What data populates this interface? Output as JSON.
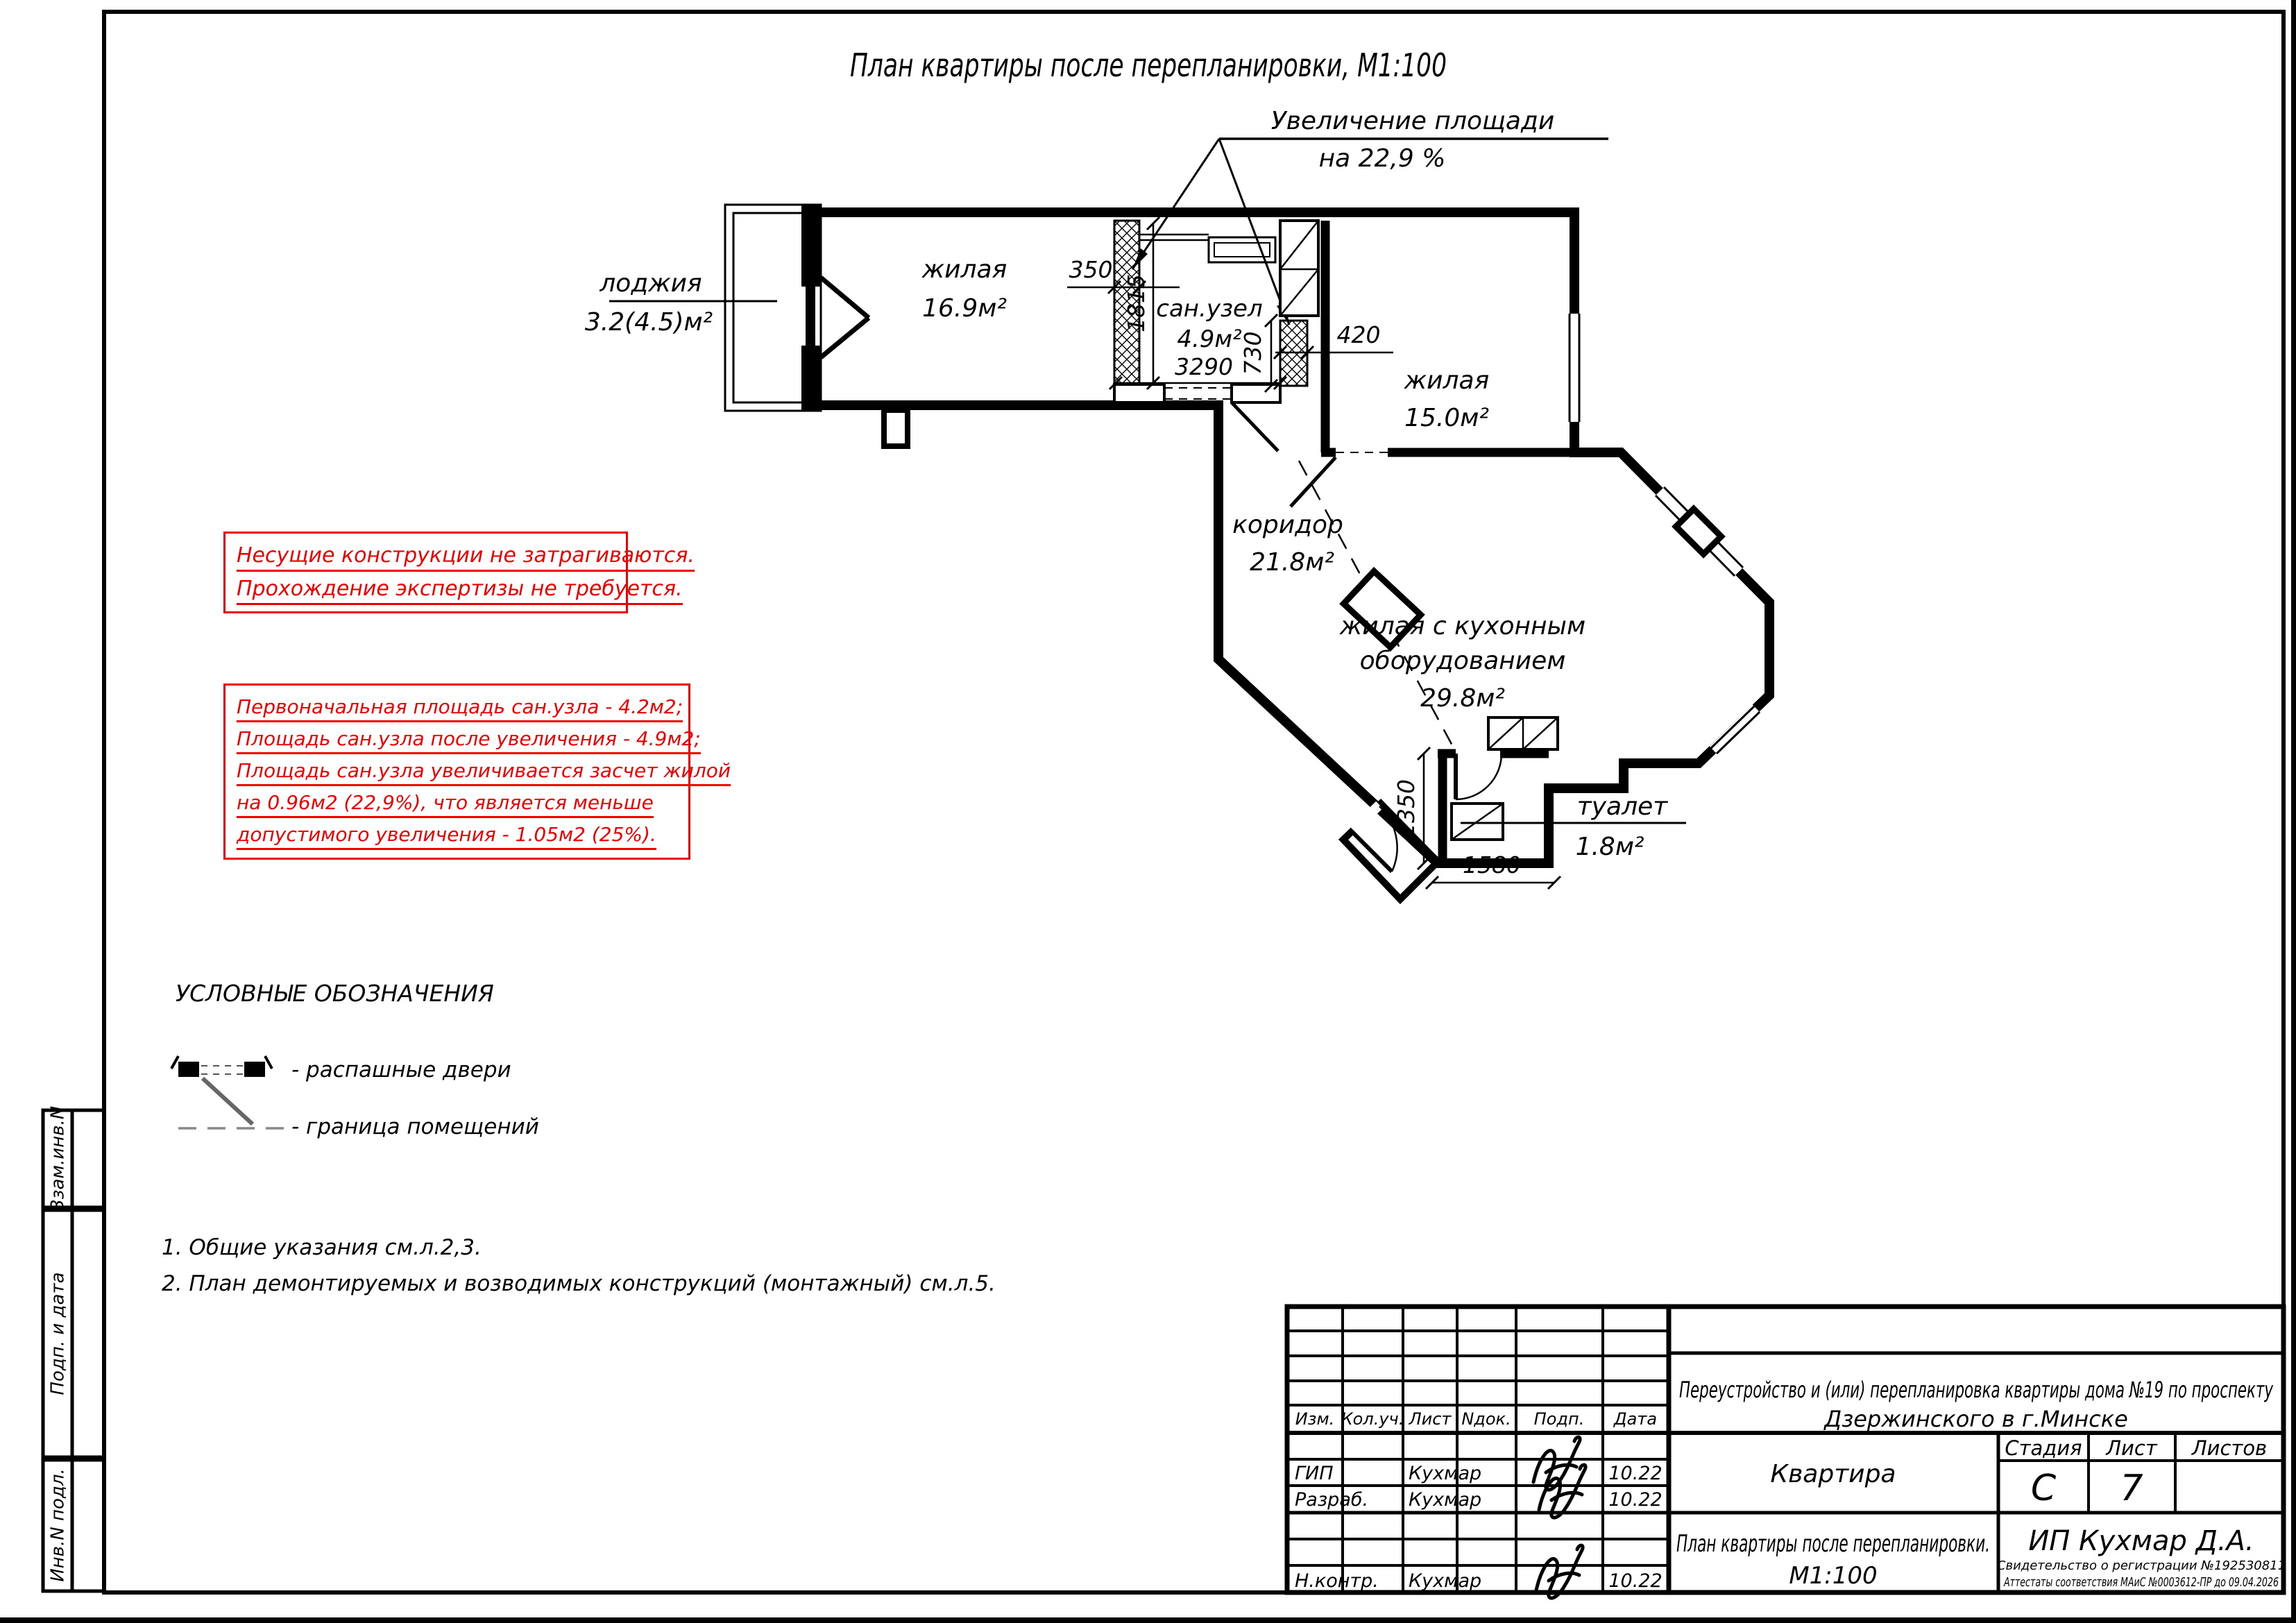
{
  "title": "План квартиры после перепланировки, М1:100",
  "callout": {
    "line1": "Увеличение площади",
    "line2": "на 22,9 %"
  },
  "rooms": {
    "loggia": {
      "name": "лоджия",
      "area": "3.2(4.5)м²"
    },
    "living1": {
      "name": "жилая",
      "area": "16.9м²"
    },
    "san": {
      "name": "сан.узел",
      "area": "4.9м²"
    },
    "living2": {
      "name": "жилая",
      "area": "15.0м²"
    },
    "corridor": {
      "name": "коридор",
      "area": "21.8м²"
    },
    "kitchen": {
      "line1": "жилая с кухонным",
      "line2": "оборудованием",
      "area": "29.8м²"
    },
    "toilet": {
      "name": "туалет",
      "area": "1.8м²"
    }
  },
  "dims": {
    "d350": "350",
    "d1815": "1815",
    "d3290": "3290",
    "d730": "730",
    "d420": "420",
    "d1350": "1350",
    "d1580": "1580"
  },
  "red_notes": {
    "block1": [
      "Несущие конструкции не затрагиваются.",
      "Прохождение экспертизы не требуется."
    ],
    "block2": [
      "Первоначальная площадь сан.узла - 4.2м2;",
      "Площадь сан.узла после увеличения - 4.9м2;",
      "Площадь сан.узла увеличивается засчет жилой",
      "на 0.96м2 (22,9%), что является меньше",
      "допустимого увеличения - 1.05м2 (25%)."
    ]
  },
  "legend": {
    "title": "УСЛОВНЫЕ ОБОЗНАЧЕНИЯ",
    "door_label": "- распашные двери",
    "boundary_label": "- граница помещений"
  },
  "notes": [
    "1. Общие указания см.л.2,3.",
    "2. План демонтируемых и возводимых конструкций (монтажный) см.л.5."
  ],
  "side_labels": [
    "Взам.инв.N",
    "Подп. и дата",
    "Инв.N подл."
  ],
  "stamp": {
    "cols": [
      "Изм.",
      "Кол.уч.",
      "Лист",
      "Nдок.",
      "Подп.",
      "Дата"
    ],
    "rows": [
      {
        "role": "ГИП",
        "name": "Кухмар",
        "date": "10.22"
      },
      {
        "role": "Разраб.",
        "name": "Кухмар",
        "date": "10.22"
      },
      {
        "role": "Н.контр.",
        "name": "Кухмар",
        "date": "10.22"
      }
    ],
    "project1": "Переустройство и (или) перепланировка квартиры дома №19 по проспекту",
    "project2": "Дзержинского в г.Минске",
    "object": "Квартира",
    "stage_label": "Стадия",
    "sheet_label": "Лист",
    "sheets_label": "Листов",
    "stage_value": "С",
    "sheet_value": "7",
    "doc1": "План квартиры после перепланировки.",
    "doc2": "М1:100",
    "company": "ИП Кухмар Д.А.",
    "cert1": "Свидетельство о регистрации №192530811",
    "cert2": "Аттестаты соответствия МАиС  №0003612-ПР  до  09.04.2026"
  },
  "colors": {
    "red": "#ee0000",
    "ink": "#000000"
  }
}
